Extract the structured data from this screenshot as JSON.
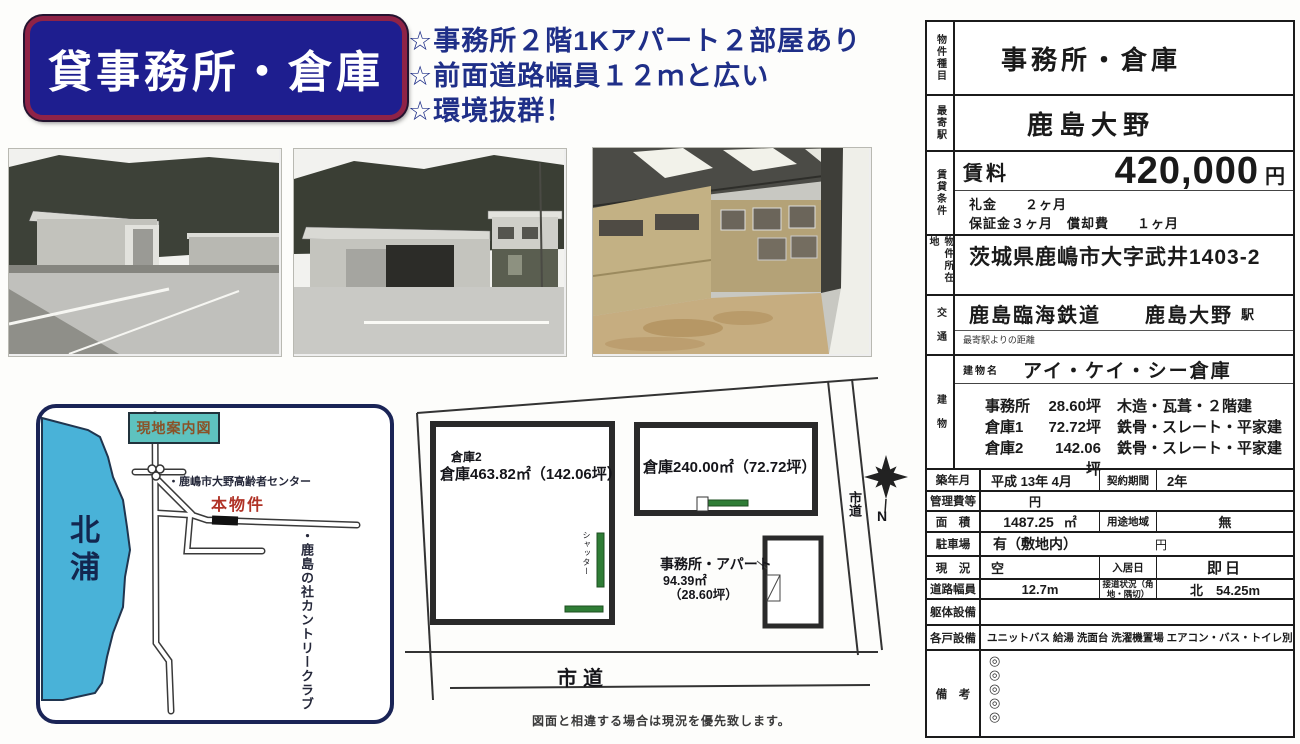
{
  "banner": {
    "title": "貸事務所・倉庫"
  },
  "highlights": [
    "☆事務所２階1Kアパート２部屋あり",
    "☆前面道路幅員１２ｍと広い",
    "☆環境抜群！"
  ],
  "map": {
    "title_box": "現地案内図",
    "lake_label": "北浦",
    "poi_center": "・鹿嶋市大野高齢者センター",
    "property_label": "本物件",
    "poi_golf": "・鹿島の社カントリークラブ"
  },
  "siteplan": {
    "warehouse2_tag": "倉庫2",
    "warehouse2_label": "倉庫463.82㎡（142.06坪）",
    "warehouse1_label": "倉庫240.00㎡（72.72坪）",
    "office_line1": "事務所・アパート",
    "office_line2": "94.39㎡",
    "office_line3": "（28.60坪）",
    "shutter_label": "シャッター",
    "road_right": "市道",
    "road_bottom": "市道",
    "north": "N",
    "caption": "図面と相違する場合は現況を優先致します。"
  },
  "table": {
    "property_type": {
      "label": "物件種目",
      "value": "事務所・倉庫"
    },
    "nearest_station": {
      "label": "最寄駅",
      "value": "鹿島大野"
    },
    "rent": {
      "label": "賃貸条件",
      "rent_label": "賃料",
      "amount": "420,000",
      "unit": "円",
      "key_money": "礼金　　２ヶ月",
      "deposit": "保証金３ヶ月　償却費　　１ヶ月"
    },
    "location": {
      "label": "物件所在地",
      "value": "茨城県鹿嶋市大字武井1403-2"
    },
    "access": {
      "label": "交　通",
      "line": "鹿島臨海鉄道　　鹿島大野",
      "suffix": "駅",
      "sub": "最寄駅よりの距離"
    },
    "building": {
      "label": "建　物",
      "name_label": "建物名",
      "name": "アイ・ケイ・シー倉庫",
      "specs": [
        {
          "name": "事務所",
          "area": "28.60坪",
          "structure": "木造・瓦葺・２階建"
        },
        {
          "name": "倉庫1",
          "area": "72.72坪",
          "structure": "鉄骨・スレート・平家建"
        },
        {
          "name": "倉庫2",
          "area": "142.06坪",
          "structure": "鉄骨・スレート・平家建"
        }
      ]
    },
    "built": {
      "label": "築年月",
      "value": "平成 13年 4月"
    },
    "contract": {
      "label": "契約期間",
      "value": "2年"
    },
    "management_fee": {
      "label": "管理費等",
      "value": "円"
    },
    "area": {
      "label": "面　積",
      "value": "1487.25",
      "unit": "㎡"
    },
    "zoning": {
      "label": "用途地域",
      "value": "無"
    },
    "parking": {
      "label": "駐車場",
      "value": "有（敷地内）",
      "unit": "円"
    },
    "status": {
      "label": "現　況",
      "value": "空"
    },
    "move_in": {
      "label": "入居日",
      "value": "即日"
    },
    "road_width": {
      "label": "道路幅員",
      "value": "12.7m"
    },
    "frontage": {
      "label": "接道状況（角地・隅切）",
      "value": "北　54.25m"
    },
    "structure_equipment": {
      "label": "躯体設備",
      "value": ""
    },
    "unit_equipment": {
      "label": "各戸設備",
      "value": "ユニットバス 給湯 洗面台 洗濯機置場 エアコン・バス・トイレ別"
    },
    "notes": {
      "label": "備　考",
      "marks": [
        "◎",
        "◎",
        "◎",
        "◎",
        "◎"
      ]
    }
  },
  "colors": {
    "banner_bg": "#1e1e8f",
    "banner_border": "#8f2347",
    "highlight_text": "#1f2f88",
    "lake_blue": "#49b2d8",
    "map_label_bg": "#5ec2bf",
    "property_red": "#b03226",
    "shutter_green": "#2f7d36"
  }
}
